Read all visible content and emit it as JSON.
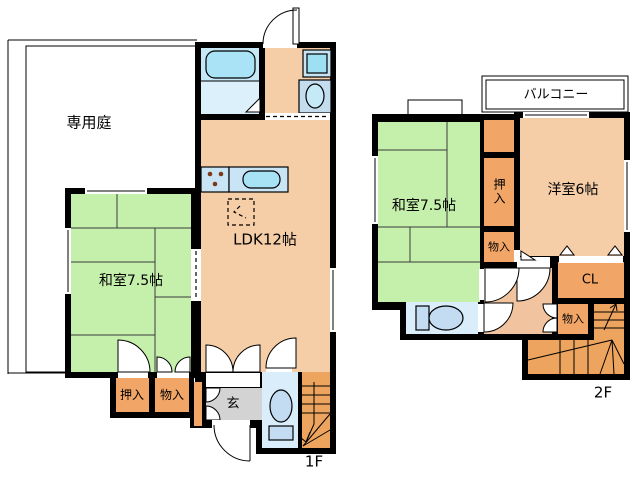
{
  "plan_title": "2-story floor plan",
  "floor1": {
    "label": "1F",
    "garden": "専用庭",
    "ldk": "LDK12帖",
    "washitsu": "和室7.5帖",
    "oshiire": "押入",
    "monoire": "物入",
    "genkan": "玄"
  },
  "floor2": {
    "label": "2F",
    "balcony": "バルコニー",
    "washitsu": "和室7.5帖",
    "youshitsu": "洋室6帖",
    "oshiire": "押入",
    "monoire_upper": "物入",
    "closet": "CL",
    "monoire_lower": "物入"
  },
  "icons": {
    "bathtub": "bathtub-icon",
    "washing_machine": "washing-machine-icon",
    "washbasin": "washbasin-icon",
    "kitchen_sink": "kitchen-sink-icon",
    "stove_burners": "stove-burner-icon",
    "refrigerator_space": "refrigerator-dashed-icon",
    "toilet": "toilet-icon",
    "stairs": "stairs-icon",
    "door_swing": "door-swing-icon"
  },
  "colors": {
    "wall": "#000000",
    "room": "#F5CDA7",
    "hall": "#F1C49F",
    "tatami": "#C5F0AC",
    "garden": "#D8CFC7",
    "closet": "#F1A566",
    "stairs": "#ECA45E",
    "bath_floor": "#DCF0FB",
    "bath_zone": "#C6E7F6",
    "bathtub": "#A9E3F5",
    "toilet_room": "#D9EEFA",
    "toilet_fixture": "#C3DCF2",
    "counter": "#C9E5F5",
    "sink": "#A7E2F5",
    "washer": "#C6E4F3",
    "washer_drum": "#9EDFF2",
    "basin_panel": "#C3DDEF",
    "basin": "#C5EAF7",
    "genkan_floor": "#D3D3D3",
    "balcony": "#DCD7D1",
    "bay_window": "#F4D7BA",
    "burner": "#7A3A16"
  }
}
